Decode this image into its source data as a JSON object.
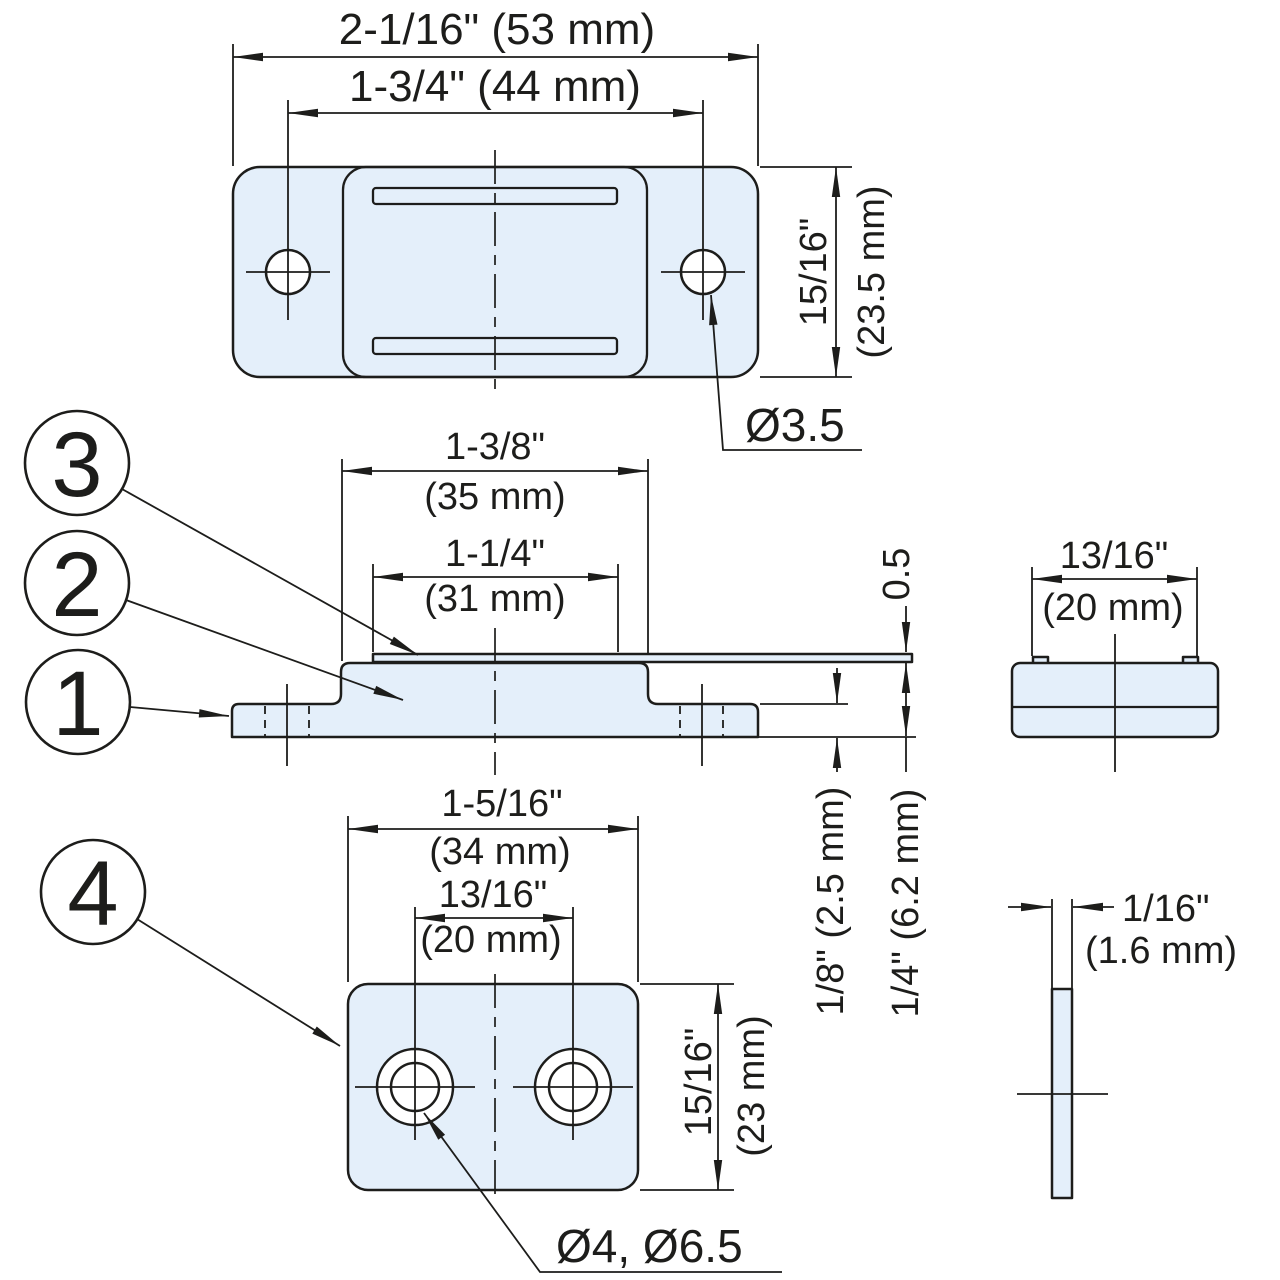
{
  "colors": {
    "part_fill": "#e4effa",
    "line": "#1d1d1b"
  },
  "callouts": {
    "item1": "1",
    "item2": "2",
    "item3": "3",
    "item4": "4"
  },
  "top_view": {
    "overall_width": "2-1/16\" (53 mm)",
    "hole_spacing": "1-3/4\" (44 mm)",
    "height_in": "15/16\"",
    "height_mm": "(23.5 mm)",
    "hole_diameter": "Ø3.5"
  },
  "side_view": {
    "body_width_in": "1-3/8\"",
    "body_width_mm": "(35 mm)",
    "plate_width_in": "1-1/4\"",
    "plate_width_mm": "(31 mm)",
    "plate_thickness": "0.5",
    "base_thickness": "1/8\" (2.5 mm)",
    "body_height": "1/4\" (6.2 mm)"
  },
  "end_view": {
    "width_in": "13/16\"",
    "width_mm": "(20 mm)"
  },
  "bottom_view": {
    "overall_width_in": "1-5/16\"",
    "overall_width_mm": "(34 mm)",
    "hole_spacing_in": "13/16\"",
    "hole_spacing_mm": "(20 mm)",
    "height_in": "15/16\"",
    "height_mm": "(23 mm)",
    "hole_diameters": "Ø4, Ø6.5"
  },
  "edge_view": {
    "thickness_in": "1/16\"",
    "thickness_mm": "(1.6 mm)"
  }
}
